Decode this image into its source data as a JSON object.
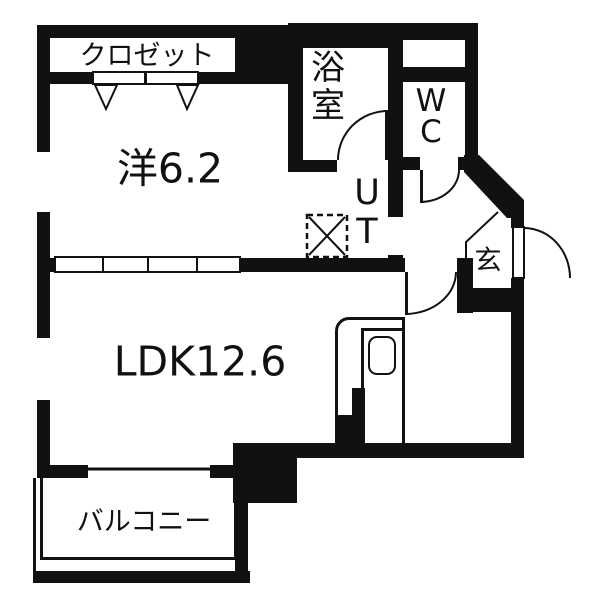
{
  "plan_type": "floor-plan",
  "colors": {
    "wall": "#111111",
    "floor": "#ffffff"
  },
  "rooms": {
    "closet": {
      "label": "クロゼット"
    },
    "western_room": {
      "label": "洋6.2"
    },
    "bathroom": {
      "label": "浴室"
    },
    "wc": {
      "label": "WC"
    },
    "utility": {
      "label": "UT"
    },
    "entrance": {
      "label": "玄"
    },
    "ldk": {
      "label": "LDK12.6"
    },
    "balcony": {
      "label": "バルコニー"
    }
  }
}
